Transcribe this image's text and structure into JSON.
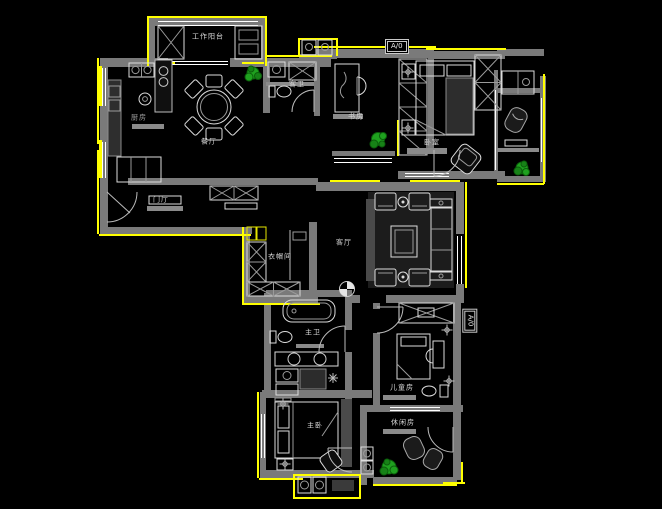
{
  "canvas": {
    "width": 662,
    "height": 509,
    "background": "#000000"
  },
  "palette": {
    "wall": "#7a7a7a",
    "trim_accent": "#ffff00",
    "furniture_line": "#dcdcdc",
    "window_line": "#ffffff",
    "plant_fill": "#1fa11f",
    "plant_shade": "#0b5e0b",
    "label_text": "#d9d9d9"
  },
  "rooms": [
    {
      "id": "work-balcony",
      "label": "工作阳台"
    },
    {
      "id": "kitchen",
      "label": "厨房"
    },
    {
      "id": "dining",
      "label": "餐厅"
    },
    {
      "id": "guest-bath",
      "label": "客卫"
    },
    {
      "id": "study",
      "label": "书房"
    },
    {
      "id": "bedroom",
      "label": "卧室"
    },
    {
      "id": "entry",
      "label": "门厅"
    },
    {
      "id": "living",
      "label": "客厅"
    },
    {
      "id": "closet",
      "label": "衣帽间"
    },
    {
      "id": "master-bath",
      "label": "主卫"
    },
    {
      "id": "kids-room",
      "label": "儿童房"
    },
    {
      "id": "master-bedroom",
      "label": "主卧"
    },
    {
      "id": "leisure-room",
      "label": "休闲房"
    }
  ],
  "markers": {
    "elevation_top": "A/0",
    "elevation_right": "A/0"
  }
}
